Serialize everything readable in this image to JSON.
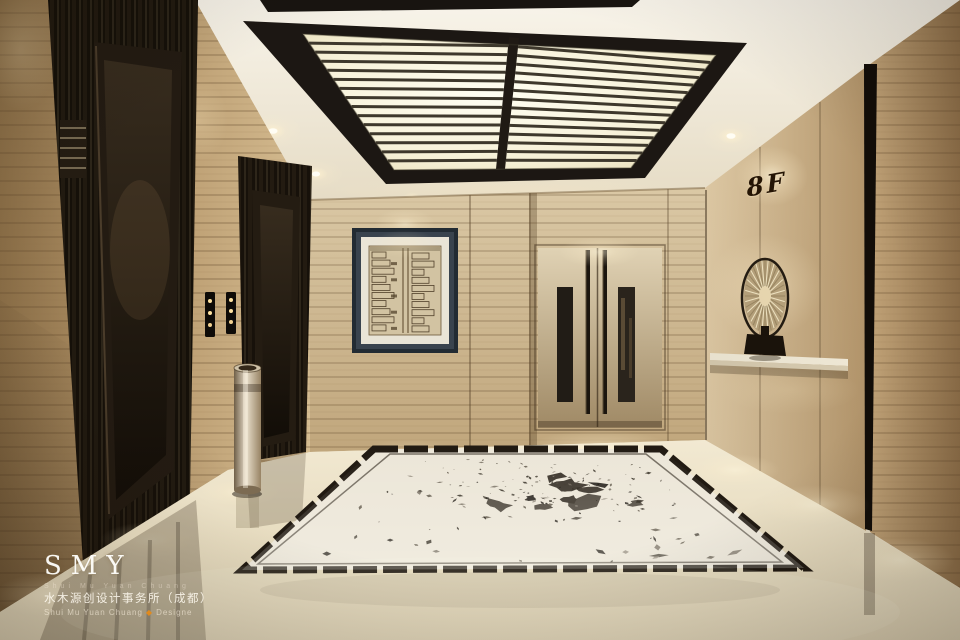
{
  "scene": {
    "floor_sign": {
      "label": "8F"
    },
    "watermark": {
      "logo": "SMY",
      "subtitle": "Shui Mu Yuan Chuang",
      "studio_name_cn": "水木源创设计事务所（成都）",
      "credit_name": "Shui Mu Yuan Chuang",
      "credit_diamond": "◆",
      "credit_role": "Designe"
    },
    "palette": {
      "ceiling_white": "#f3eee2",
      "skylight_frame": "#1c1713",
      "skylight_glow": "#fdfae8",
      "travertine_light": "#d3ba8f",
      "travertine_dark": "#8d7048",
      "black_marble": "#17110a",
      "floor_cream": "#e9dfc6",
      "medallion_ink": "#1c1610",
      "accent_orange": "#e08a1e"
    }
  }
}
